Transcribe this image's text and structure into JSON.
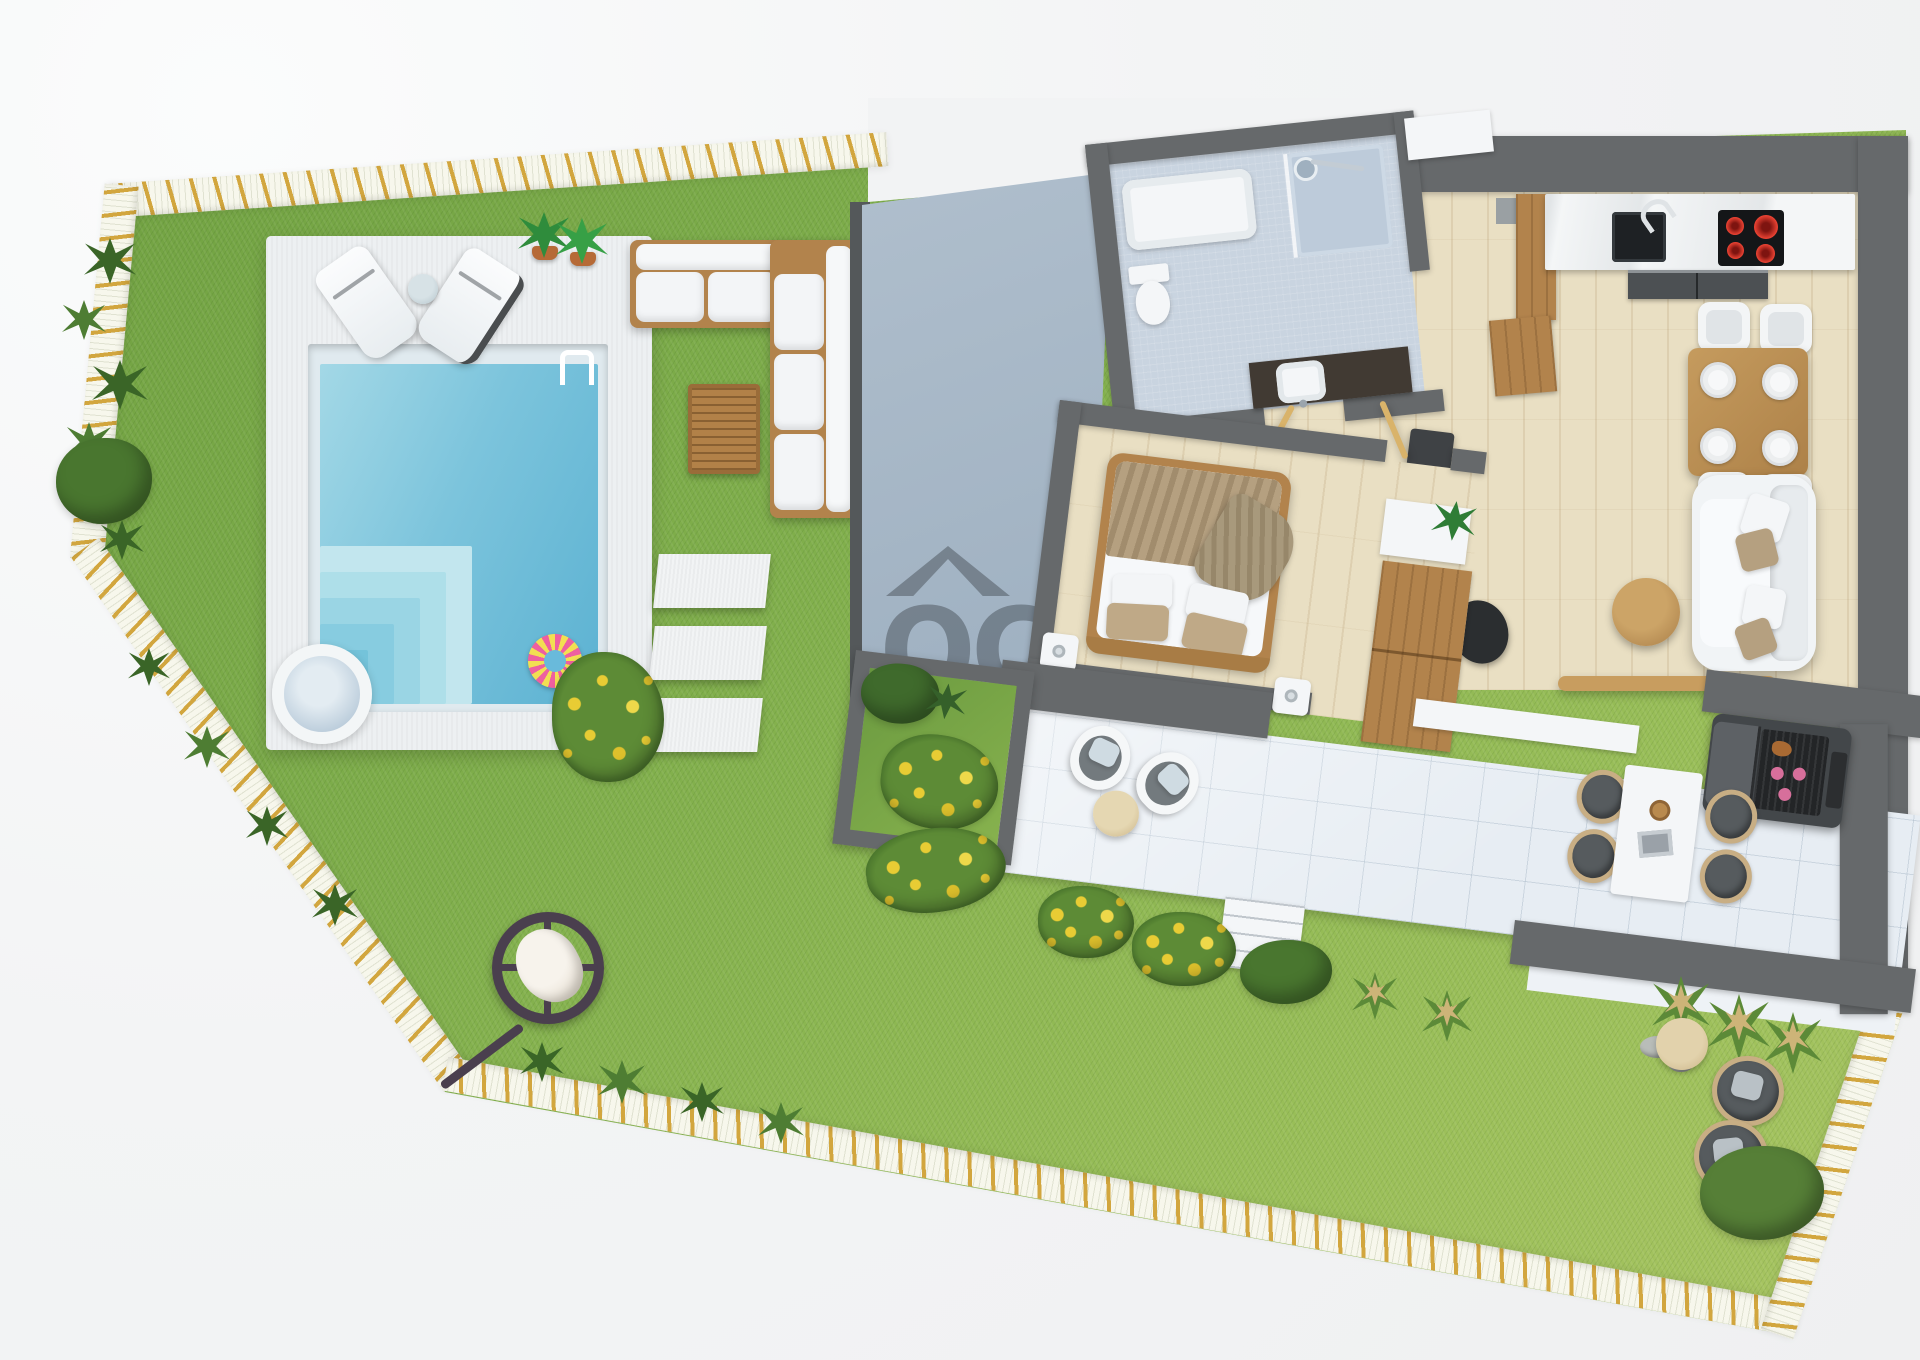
{
  "watermark": {
    "roof_icon": "house-roof-icon",
    "logo_text": "OC",
    "partial_line_1": "N",
    "partial_line_2": "M"
  },
  "palette": {
    "bg": "#f2f3f4",
    "grass": "#7fae4b",
    "grass_light": "#9cc05a",
    "grass_dark": "#6fa041",
    "border_base": "#f7f7ec",
    "border_stripe": "#d2a63e",
    "deck": "#edf0f2",
    "pool_rim": "#e0eaef",
    "pool": "#7cc4dc",
    "pool_deep": "#5cb2d2",
    "pool_step": "#b9e2ec",
    "wall": "#66696b",
    "wall_dark": "#54585a",
    "roof_light": "#bdcad6",
    "roof_dark": "#8299af",
    "wood_floor": "#e9dfc3",
    "wood": "#b2834c",
    "tile": "#e7edf3",
    "bath_floor": "#c9d4e0",
    "white_furn": "#f4f6f8",
    "beige": "#b5a080",
    "ring_pink": "#ee5fa0",
    "ring_yellow": "#f2df52",
    "flower": "#e8cc34",
    "leaf": "#49762f",
    "leaf_dark": "#3a6527",
    "watermark_color": "rgba(45,50,56,0.38)"
  },
  "legend": {
    "garden": "Garden lawn",
    "border": "Plot boundary",
    "deck": "Pool deck",
    "pool": "Swimming pool",
    "steps": "Pool steps",
    "swim_ring": "Swim ring float",
    "hot_tub": "Hot tub",
    "ladder": "Pool ladder",
    "loungers": "Sun loungers",
    "outdoor_sofa": "Outdoor corner sofa",
    "coffee_table": "Wooden coffee table",
    "stepping_stones": "Stepping stones",
    "hanging_chair": "Hanging egg chair",
    "roof": "Adjacent roof",
    "courtyard": "Planted courtyard",
    "bathroom": "Bathroom",
    "bedroom": "Bedroom",
    "hallway": "Hallway",
    "kitchen": "Kitchen",
    "dining": "Dining area",
    "living": "Living room",
    "terrace": "Terrace",
    "bbq": "Barbecue grill",
    "patio_seating": "Patio seating",
    "garden_seating": "Garden seating",
    "entrance": "Entrance"
  }
}
